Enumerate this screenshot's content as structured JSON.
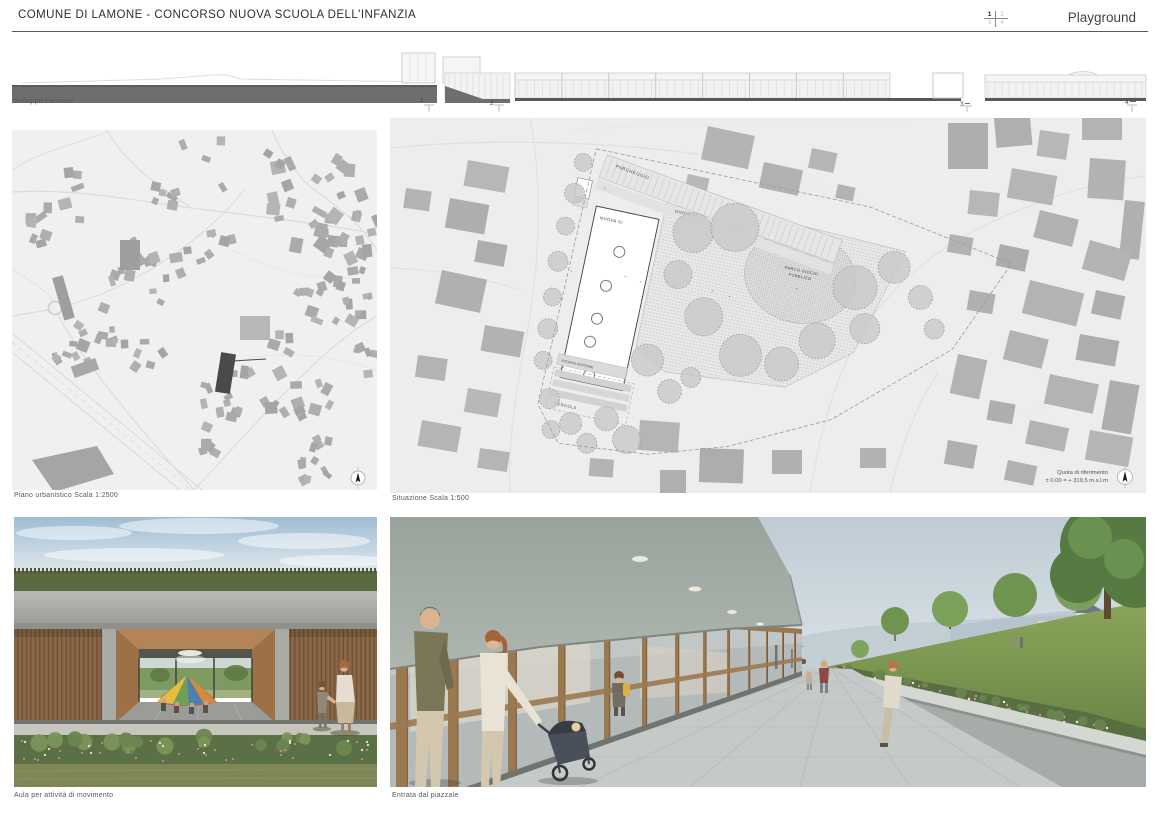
{
  "header": {
    "title": "COMUNE DI LAMONE - CONCORSO NUOVA SCUOLA DELL'INFANZIA",
    "sheet_name": "Playground",
    "sheet_grid": {
      "cells": [
        "1",
        "2",
        "3",
        "4"
      ],
      "active": "1"
    }
  },
  "facades": {
    "label": "Sviluppo Facciate",
    "markers": [
      "1",
      "2",
      "3",
      "4"
    ]
  },
  "plans": {
    "urban": {
      "caption": "Piano urbanistico Scala 1:2500"
    },
    "site": {
      "caption": "Situazione Scala 1:500",
      "labels": {
        "parking": "PARCHEGGIO",
        "new_school": "NUOVA SI",
        "play_area": "GIOCO SI",
        "public_playground_1": "PARCO GIOCHI",
        "public_playground_2": "PUBBLICO",
        "entry_mgmt": "ENTRATA GESTIONE",
        "pergola": "PERGOLA",
        "level_mark": "+"
      },
      "reference": {
        "line1": "Quota di riferimento",
        "line2": "± 0.00 = + 319,5 m.s.l.m"
      }
    }
  },
  "renders": {
    "movement_room_caption": "Aula per attività di movimento",
    "entrance_caption": "Entrata dal piazzale"
  },
  "colors": {
    "highlight_building": "#4a4a4a",
    "map_building": "#adadad",
    "map_background": "#f1f0ef",
    "facade_dark": "#6e6e6e"
  }
}
